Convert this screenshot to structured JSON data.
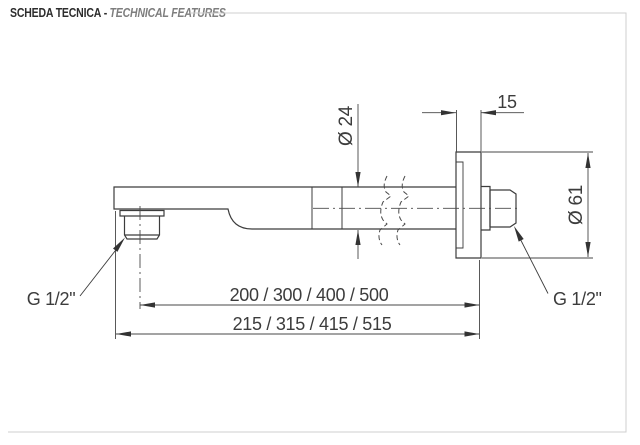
{
  "header": {
    "title_it": "SCHEDA TECNICA",
    "separator": "-",
    "title_en": "TECHNICAL FEATURES"
  },
  "drawing": {
    "subject": "wall-mounted shower arm, side view with break lines",
    "dimensions": {
      "wall_flange_thickness": "15",
      "arm_diameter": "Ø 24",
      "wall_flange_diameter": "Ø 61",
      "arm_length_options": "200 / 300 / 400 / 500",
      "overall_length_options": "215 / 315 / 415 / 515",
      "outlet_thread": "G 1/2\"",
      "inlet_thread": "G 1/2\""
    },
    "colors": {
      "line": "#3c3c3c",
      "dimension_line": "#474747",
      "frame": "#cfcfcf",
      "header_primary": "#2d2d2d",
      "header_secondary": "#7e7e7e"
    }
  }
}
